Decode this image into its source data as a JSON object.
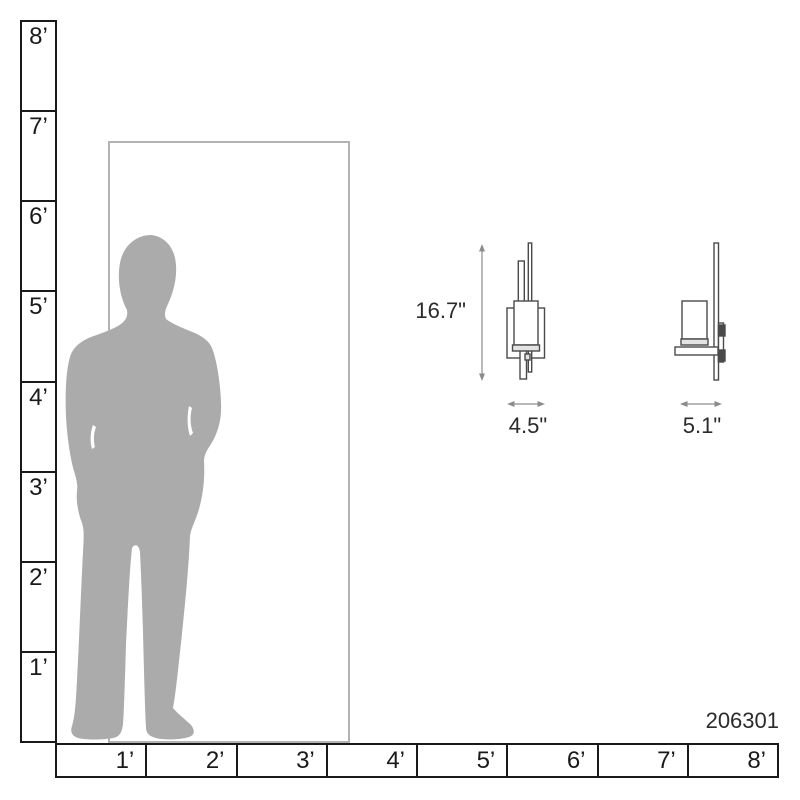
{
  "product": {
    "model_number": "206301"
  },
  "ruler": {
    "vertical_labels": [
      "8’",
      "7’",
      "6’",
      "5’",
      "4’",
      "3’",
      "2’",
      "1’"
    ],
    "horizontal_labels": [
      "1’",
      "2’",
      "3’",
      "4’",
      "5’",
      "6’",
      "7’",
      "8’"
    ]
  },
  "dimensions": {
    "height": "16.7\"",
    "width": "4.5\"",
    "depth": "5.1\""
  },
  "icons": {
    "person_silhouette": "standing-man-scale-figure",
    "height_arrow": "vertical-double-arrow",
    "width_arrow": "horizontal-double-arrow",
    "depth_arrow": "horizontal-double-arrow"
  },
  "colors": {
    "silhouette": "#ababab",
    "door_outline": "#b3b3b3",
    "ruler_line": "#1a1a1a",
    "dimension_line": "#8c8c8c",
    "drawing_stroke": "#4a4a4a",
    "text": "#2b2b2b"
  }
}
